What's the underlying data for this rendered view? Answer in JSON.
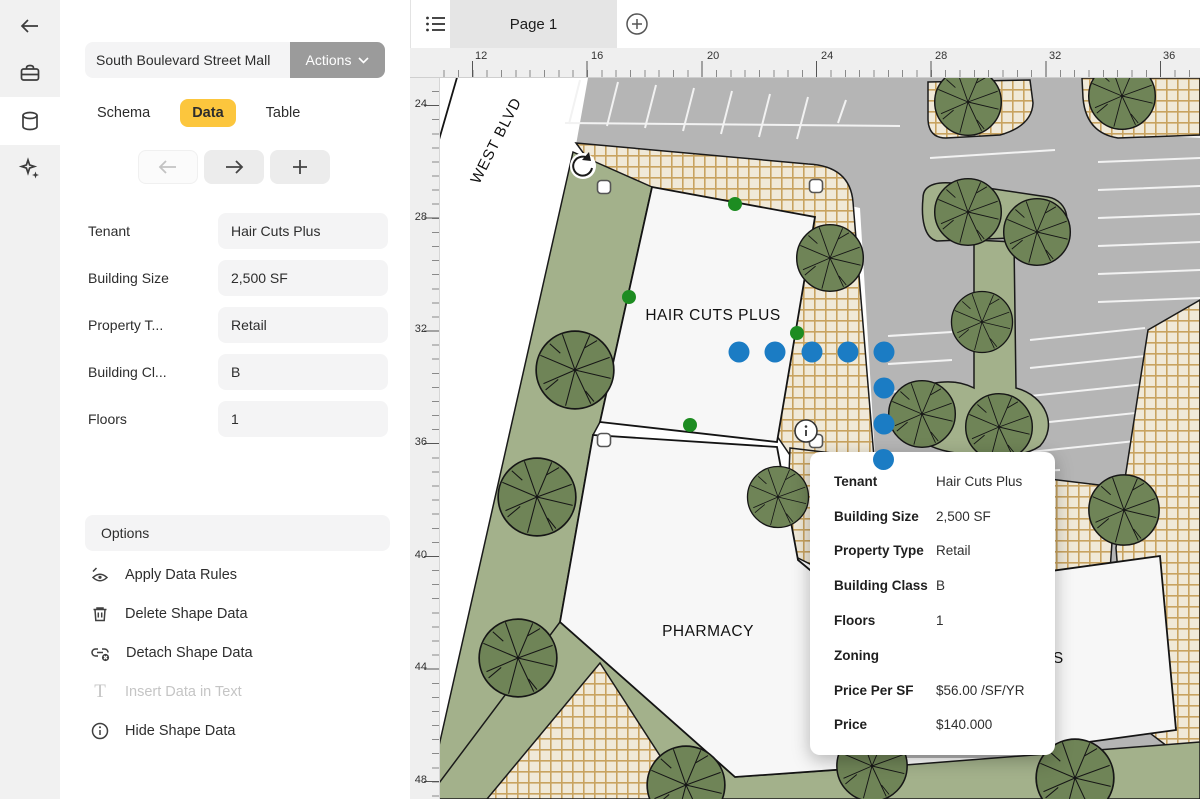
{
  "sidebar": {
    "icons": [
      "back-arrow",
      "toolbox",
      "data-cylinder",
      "magic-sparkles"
    ]
  },
  "panel": {
    "dataset_title": "South Boulevard Street Mall",
    "actions_button": "Actions",
    "tabs": [
      {
        "label": "Schema",
        "active": false
      },
      {
        "label": "Data",
        "active": true
      },
      {
        "label": "Table",
        "active": false
      }
    ],
    "fields": [
      {
        "label": "Tenant",
        "value": "Hair Cuts Plus"
      },
      {
        "label": "Building Size",
        "value": "2,500 SF"
      },
      {
        "label": "Property T...",
        "value": "Retail"
      },
      {
        "label": "Building Cl...",
        "value": "B"
      },
      {
        "label": "Floors",
        "value": "1"
      }
    ],
    "options_header": "Options",
    "options": [
      {
        "label": "Apply Data Rules",
        "disabled": false
      },
      {
        "label": "Delete Shape Data",
        "disabled": false
      },
      {
        "label": "Detach Shape Data",
        "disabled": false
      },
      {
        "label": "Insert Data in Text",
        "disabled": true
      },
      {
        "label": "Hide Shape Data",
        "disabled": false
      }
    ]
  },
  "tabbar": {
    "page_tab": "Page 1"
  },
  "rulers": {
    "horizontal": [
      "12",
      "16",
      "20",
      "24",
      "28",
      "32",
      "36"
    ],
    "vertical": [
      "24",
      "28",
      "32",
      "36",
      "40",
      "44",
      "48"
    ]
  },
  "map": {
    "street_label": "WEST BLVD",
    "building_labels": [
      "HAIR CUTS PLUS",
      "PHARMACY"
    ],
    "partial_label": "S"
  },
  "tooltip": {
    "rows": [
      {
        "label": "Tenant",
        "value": "Hair Cuts Plus"
      },
      {
        "label": "Building Size",
        "value": "2,500 SF"
      },
      {
        "label": "Property Type",
        "value": "Retail"
      },
      {
        "label": "Building Class",
        "value": "B"
      },
      {
        "label": "Floors",
        "value": "1"
      },
      {
        "label": "Zoning",
        "value": ""
      },
      {
        "label": "Price Per SF",
        "value": "$56.00 /SF/YR"
      },
      {
        "label": "Price",
        "value": "$140.000"
      }
    ]
  },
  "colors": {
    "accent_blue": "#1b7cc4",
    "connection_green": "#1d8c21",
    "tab_yellow": "#fcc63d",
    "actions_gray": "#9b9b9b",
    "road_gray": "#b5b5b5",
    "grass_green": "#a3b18b",
    "tree_green": "#6f8457",
    "hatch_bg": "#f0e9d8",
    "hatch_line": "#c8a360"
  }
}
